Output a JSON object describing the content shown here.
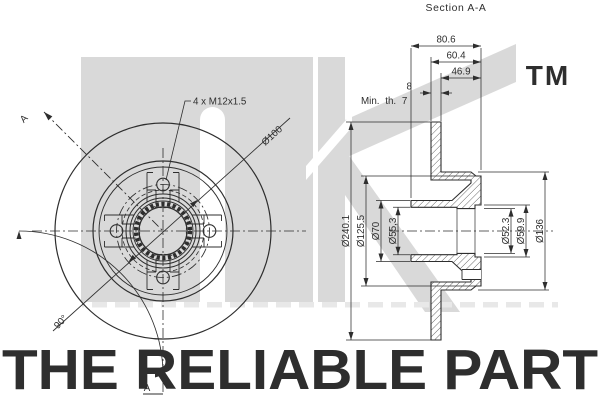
{
  "colors": {
    "line": "#2e2e2e",
    "watermark_gray": "#d9d9d9",
    "watermark_text": "#d6d6d6",
    "tm_gray": "#dedede",
    "background": "#ffffff"
  },
  "watermark": {
    "tm": "TM",
    "tagline": "THE RELIABLE PART"
  },
  "front_view": {
    "thread_note": "4 x M12x1.5",
    "bolt_circle_dia": "Ø100",
    "section_angle": "90°",
    "cut_label_top": "A",
    "cut_label_bottom": "A"
  },
  "section_view": {
    "title": "Section A-A",
    "overall_width": "80.6",
    "hub_width": "60.4",
    "hub_inner_width": "46.9",
    "disc_thickness": "8",
    "min_thickness_note": "Min. th. 7",
    "outer_dia": "Ø240.1",
    "flange_dia": "Ø125.5",
    "tube_dia": "Ø70",
    "bore_dia_left": "Ø55,3",
    "bore_dia_center": "Ø52.3",
    "seal_dia": "Ø59.9",
    "hub_dia": "Ø136"
  }
}
